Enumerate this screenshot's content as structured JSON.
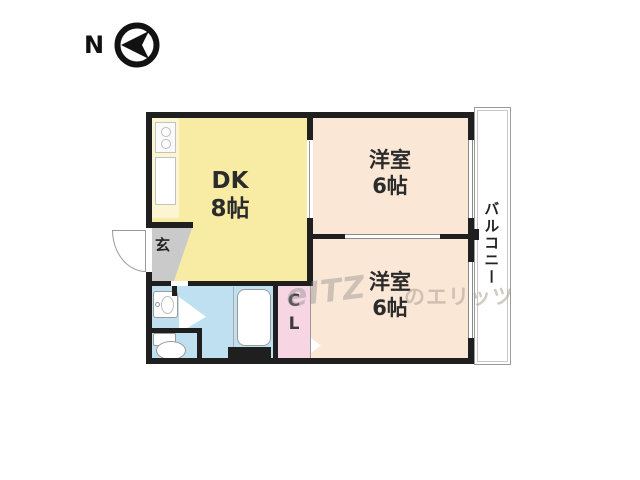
{
  "compass": {
    "label": "N",
    "icon": "compass-west-arrow-icon"
  },
  "plan": {
    "wall_color": "#1f1f1f",
    "rooms": {
      "dk": {
        "name": "DK",
        "size": "8帖",
        "color": "#f8eba4"
      },
      "western_top": {
        "name": "洋室",
        "size": "6帖",
        "color": "#fbe7d6"
      },
      "western_bottom": {
        "name": "洋室",
        "size": "6帖",
        "color": "#fbe7d6"
      },
      "entrance": {
        "label": "玄",
        "color": "#cacaca"
      },
      "closet": {
        "line1": "C",
        "line2": "L",
        "color": "#f7d5e2"
      },
      "balcony": {
        "label": "バルコニー",
        "color": "#ffffff"
      },
      "wet_area": {
        "color": "#bee0f1"
      }
    },
    "fixtures": [
      "stove",
      "kitchen-sink",
      "washbasin",
      "toilet",
      "bathtub",
      "bath-door",
      "entrance-door",
      "closet-door",
      "pipe-space"
    ]
  },
  "watermark": {
    "logo": "eITZ",
    "text": "のエリッツ"
  }
}
